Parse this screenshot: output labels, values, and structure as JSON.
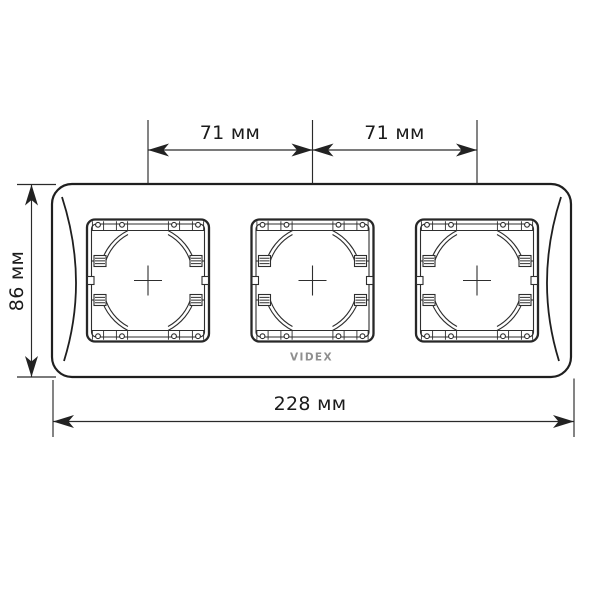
{
  "diagram": {
    "title": "Triple wall plate dimension drawing",
    "brand": "VIDEX",
    "dimensions": {
      "top_left_span": "71 мм",
      "top_right_span": "71 мм",
      "height": "86 мм",
      "width": "228 мм"
    },
    "colors": {
      "line": "#1f1f1f",
      "dimension_line": "#2a2a2a",
      "logo": "#8f8f8f",
      "background": "#ffffff"
    },
    "openings_count": 3
  }
}
